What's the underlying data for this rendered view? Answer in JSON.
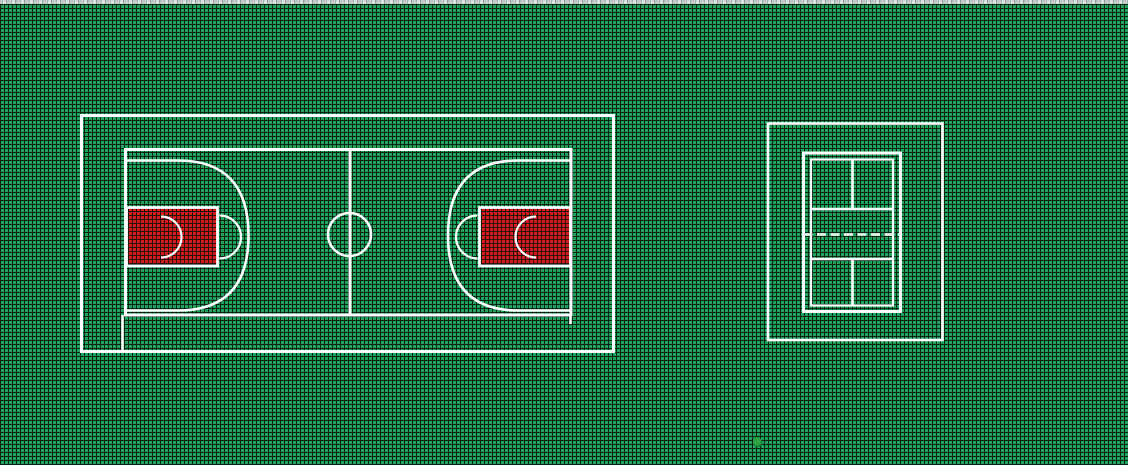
{
  "scene": {
    "title": "Outdoor sport tile surface plan view",
    "description": "Top-down schematic of a green modular-tile sport surface containing a full basketball court with red painted keys on the left and a pickleball-style court with dashed net line on the right",
    "surface_texture": "green square tiles separated by dark grid gaps",
    "top_edge_artifact": "thin gray noise band along the top edge",
    "stray_mark": "small bright green smudge near bottom center"
  },
  "colors": {
    "tile_green": "#1ea25c",
    "tile_gap": "#07130bdd",
    "line_white": "#ffffff",
    "key_red": "#da1a1a",
    "net_dash": "#e2f2e8",
    "green_mark": "#2fa344"
  },
  "basketball_court": {
    "label": "basketball court",
    "features": [
      "outer apron boundary rectangle",
      "court boundary rectangle",
      "half-court line",
      "center circle",
      "left three-point line",
      "right three-point line",
      "left red key with white outline",
      "right red key with white outline",
      "left free-throw semicircle",
      "right free-throw semicircle",
      "left restricted-area arc",
      "right restricted-area arc"
    ]
  },
  "pickleball_court": {
    "label": "pickleball court",
    "features": [
      "outer apron boundary rectangle",
      "court boundary rectangle",
      "inner sideline/baseline rectangle",
      "upper non-volley (kitchen) line",
      "lower non-volley (kitchen) line",
      "upper center service line",
      "lower center service line",
      "dashed net line across middle"
    ]
  }
}
